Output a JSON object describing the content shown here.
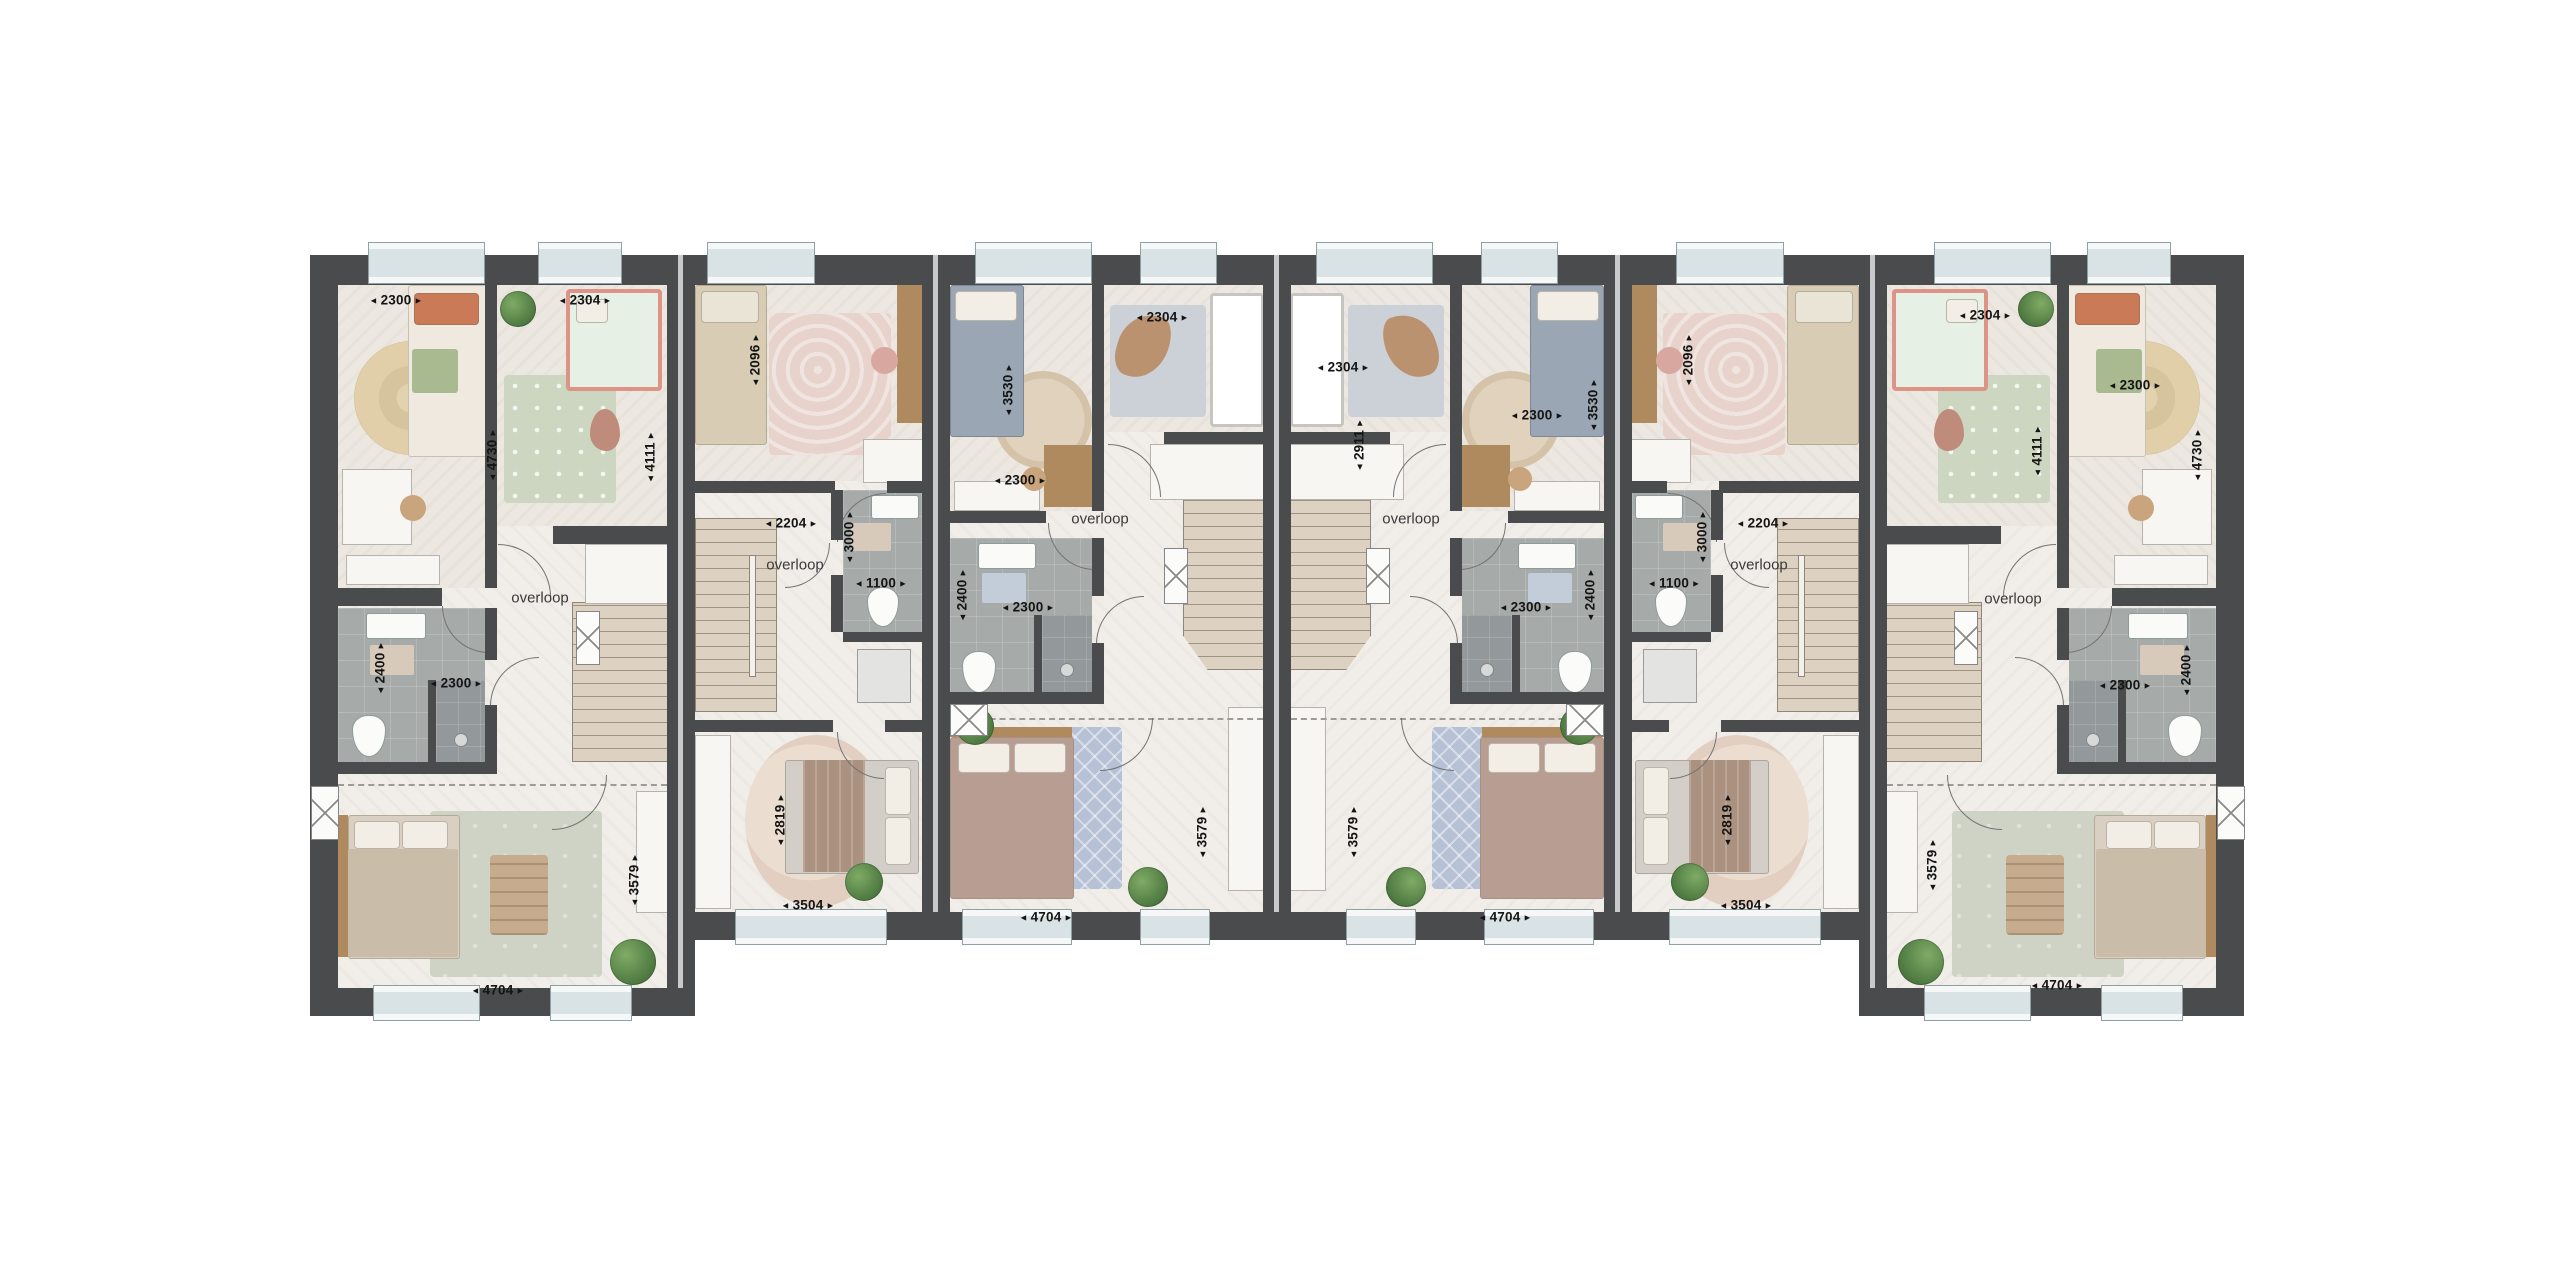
{
  "plan": {
    "type": "floor-plan",
    "landing_label": "overloop",
    "palette": {
      "wall": "#4a4b4d",
      "floor": "#f1eee9",
      "room_floor": "#ece8e1",
      "bathroom_tile": "#a6aaa8",
      "shower_tile": "#93989a",
      "stairs": "#ddd2c1",
      "window_pane": "#d9e3e5",
      "window_frame": "#f6f8f8",
      "label_text": "#141414"
    },
    "units": [
      {
        "id": "unit-1",
        "layout": "end",
        "mirrored": false,
        "landing": {
          "xy": [
            202,
            343
          ]
        },
        "dims": [
          {
            "v": "2300",
            "o": "h",
            "xy": [
              58,
              45
            ]
          },
          {
            "v": "2304",
            "o": "h",
            "xy": [
              247,
              45
            ]
          },
          {
            "v": "4730",
            "o": "v",
            "xy": [
              154,
              200
            ]
          },
          {
            "v": "4111",
            "o": "v",
            "xy": [
              312,
              202
            ]
          },
          {
            "v": "2400",
            "o": "v",
            "xy": [
              42,
              413
            ]
          },
          {
            "v": "2300",
            "o": "h",
            "xy": [
              118,
              428
            ]
          },
          {
            "v": "3579",
            "o": "v",
            "xy": [
              296,
              625
            ]
          },
          {
            "v": "4704",
            "o": "h",
            "xy": [
              160,
              735
            ]
          }
        ]
      },
      {
        "id": "unit-2",
        "layout": "mid-small",
        "mirrored": false,
        "landing": {
          "xy": [
            100,
            310
          ]
        },
        "dims": [
          {
            "v": "2096",
            "o": "v",
            "xy": [
              60,
              105
            ]
          },
          {
            "v": "2204",
            "o": "h",
            "xy": [
              96,
              268
            ]
          },
          {
            "v": "3000",
            "o": "v",
            "xy": [
              154,
              282
            ]
          },
          {
            "v": "1100",
            "o": "h",
            "xy": [
              186,
              328
            ]
          },
          {
            "v": "2819",
            "o": "v",
            "xy": [
              85,
              565
            ]
          },
          {
            "v": "3504",
            "o": "h",
            "xy": [
              113,
              650
            ]
          }
        ]
      },
      {
        "id": "unit-3",
        "layout": "mid-large",
        "mirrored": false,
        "landing": {
          "xy": [
            150,
            264
          ]
        },
        "dims": [
          {
            "v": "3530",
            "o": "v",
            "xy": [
              58,
              135
            ]
          },
          {
            "v": "2300",
            "o": "h",
            "xy": [
              70,
              225
            ]
          },
          {
            "v": "2304",
            "o": "h",
            "xy": [
              212,
              62
            ]
          },
          {
            "v": "2400",
            "o": "v",
            "xy": [
              12,
              340
            ]
          },
          {
            "v": "2300",
            "o": "h",
            "xy": [
              78,
              352
            ]
          },
          {
            "v": "3579",
            "o": "v",
            "xy": [
              252,
              577
            ]
          },
          {
            "v": "4704",
            "o": "h",
            "xy": [
              96,
              662
            ]
          }
        ]
      },
      {
        "id": "unit-4",
        "layout": "mid-large",
        "mirrored": true,
        "landing": {
          "xy": [
            120,
            264
          ]
        },
        "dims": [
          {
            "v": "2304",
            "o": "h",
            "xy": [
              52,
              112
            ]
          },
          {
            "v": "2911",
            "o": "v",
            "xy": [
              68,
              190
            ]
          },
          {
            "v": "2300",
            "o": "h",
            "xy": [
              246,
              160
            ]
          },
          {
            "v": "3530",
            "o": "v",
            "xy": [
              302,
              150
            ]
          },
          {
            "v": "2400",
            "o": "v",
            "xy": [
              299,
              340
            ]
          },
          {
            "v": "2300",
            "o": "h",
            "xy": [
              235,
              352
            ]
          },
          {
            "v": "3579",
            "o": "v",
            "xy": [
              62,
              577
            ]
          },
          {
            "v": "4704",
            "o": "h",
            "xy": [
              214,
              662
            ]
          }
        ]
      },
      {
        "id": "unit-5",
        "layout": "mid-small",
        "mirrored": true,
        "landing": {
          "xy": [
            127,
            310
          ]
        },
        "dims": [
          {
            "v": "2096",
            "o": "v",
            "xy": [
              56,
              105
            ]
          },
          {
            "v": "2204",
            "o": "h",
            "xy": [
              131,
              268
            ]
          },
          {
            "v": "3000",
            "o": "v",
            "xy": [
              70,
              282
            ]
          },
          {
            "v": "1100",
            "o": "h",
            "xy": [
              42,
              328
            ]
          },
          {
            "v": "2819",
            "o": "v",
            "xy": [
              95,
              565
            ]
          },
          {
            "v": "3504",
            "o": "h",
            "xy": [
              114,
              650
            ]
          }
        ]
      },
      {
        "id": "unit-6",
        "layout": "end",
        "mirrored": true,
        "landing": {
          "xy": [
            126,
            344
          ]
        },
        "dims": [
          {
            "v": "2304",
            "o": "h",
            "xy": [
              98,
              60
            ]
          },
          {
            "v": "4111",
            "o": "v",
            "xy": [
              150,
              196
            ]
          },
          {
            "v": "2300",
            "o": "h",
            "xy": [
              248,
              130
            ]
          },
          {
            "v": "4730",
            "o": "v",
            "xy": [
              310,
              200
            ]
          },
          {
            "v": "2400",
            "o": "v",
            "xy": [
              299,
              415
            ]
          },
          {
            "v": "2300",
            "o": "h",
            "xy": [
              238,
              430
            ]
          },
          {
            "v": "3579",
            "o": "v",
            "xy": [
              45,
              610
            ]
          },
          {
            "v": "4704",
            "o": "h",
            "xy": [
              170,
              730
            ]
          }
        ]
      }
    ]
  }
}
